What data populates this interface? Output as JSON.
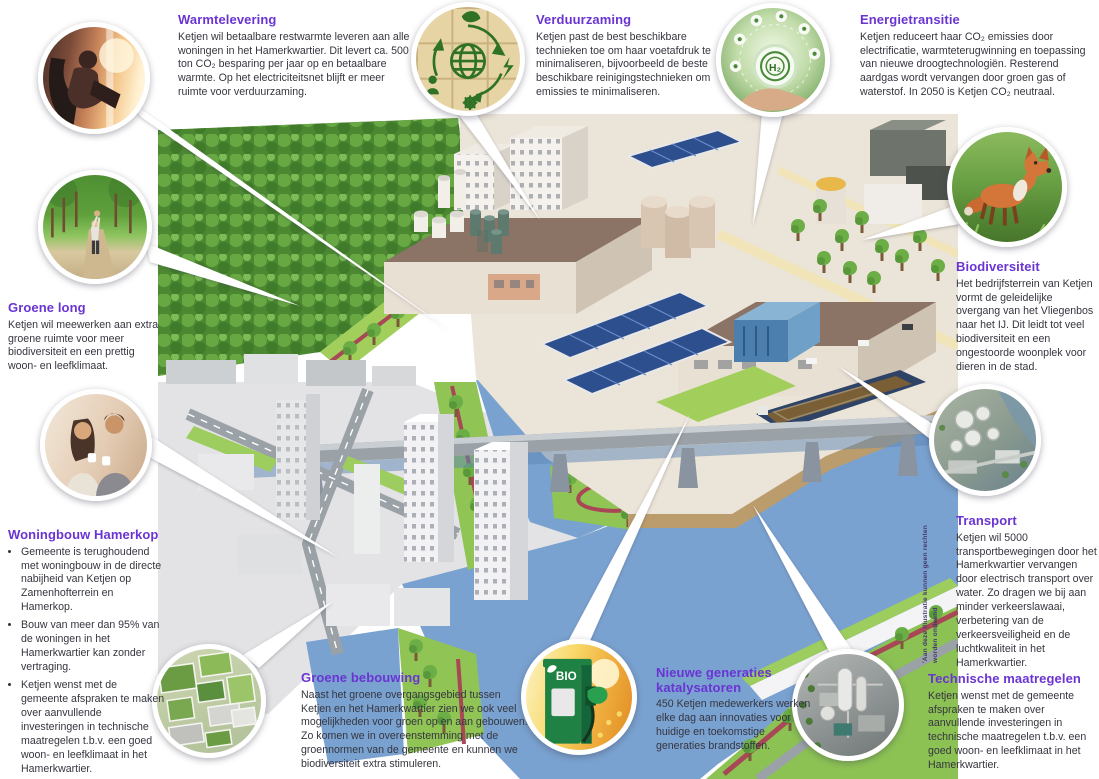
{
  "colors": {
    "accent_purple": "#6a34d2",
    "body_text": "#35353f",
    "river_blue": "#7aa2d0",
    "forest_green": "#4c8832",
    "grass_green": "#9ccd5e",
    "red_path": "#a84856",
    "roof_brown": "#8b7365",
    "solar_blue": "#2e4f8e"
  },
  "callouts": [
    {
      "id": "warmtelevering",
      "title": "Warmtelevering",
      "body": "Ketjen wil betaalbare restwarmte leveren aan alle woningen in het Hamerkwartier. Dit levert ca. 500 ton CO₂ besparing per jaar op en betaalbare warmte. Op het electriciteitsnet blijft er meer ruimte voor verduurzaming.",
      "photo": "woman-by-sunny-window"
    },
    {
      "id": "verduurzaming",
      "title": "Verduurzaming",
      "body": "Ketjen past de best beschikbare technieken toe om haar voetafdruk te minimaliseren, bijvoorbeeld de beste beschikbare reinigings­technieken om emissies te minimaliseren.",
      "photo": "sustainability-icons-on-wood-blocks"
    },
    {
      "id": "energietransitie",
      "title": "Energietransitie",
      "body": "Ketjen reduceert haar CO₂ emissies door electrificatie, warmteterugwinning en toepassing van nieuwe droogtechnologiën. Resterend aardgas wordt vervangen door groen gas of waterstof. In 2050 is Ketjen CO₂ neutraal.",
      "photo": "hand-holding-h2-sphere"
    },
    {
      "id": "biodiversiteit",
      "title": "Biodiversiteit",
      "body": "Het bedrijfsterrein van Ketjen vormt de geleidelijke overgang van het Vliegenbos naar het IJ. Dit leidt tot veel biodiversiteit en een ongestoorde woonplek voor dieren in de stad.",
      "photo": "fox-in-grass"
    },
    {
      "id": "transport",
      "title": "Transport",
      "body": "Ketjen wil 5000 transportbewegingen door het Hamerkwartier vervangen door electrisch transport over water. Zo dragen we bij aan minder verkeerslawaai, verbetering van de verkeersveiligheid en de luchtkwaliteit in het Hamerkwartier.",
      "photo": "aerial-industrial-waterfront"
    },
    {
      "id": "technische-maatregelen",
      "title": "Technische maatregelen",
      "body": "Ketjen wenst met de gemeente afspraken te maken over aanvullende investeringen in technische maatregelen t.b.v. een goed woon- en leefklimaat in het Hamerkwartier.",
      "photo": "aerial-chemical-plant"
    },
    {
      "id": "nieuwe-generaties-katalysatoren",
      "title": "Nieuwe generaties katalysatoren",
      "body": "450 Ketjen medewerkers werken elke dag aan innovaties voor huidige en toekomstige generaties brandstoffen.",
      "photo": "bio-fuel-pump"
    },
    {
      "id": "groene-bebouwing",
      "title": "Groene bebouwing",
      "body": "Naast het groene overgangsgebied tussen Ketjen en het Hamerkwartier zien we ook veel mogelijkheden voor groen op en aan gebouwen. Zo komen we in overeenstemming met de groennormen van de gemeente en kunnen we biodiversiteit extra stimuleren.",
      "photo": "green-roofs-aerial"
    },
    {
      "id": "groene-long",
      "title": "Groene long",
      "body": "Ketjen wil meewerken aan extra groene ruimte voor meer biodiversiteit en een prettig woon- en leefklimaat.",
      "photo": "family-on-park-path"
    },
    {
      "id": "woningbouw-hamerkop",
      "title": "Woningbouw Hamerkop",
      "bullets": [
        "Gemeente is terughoudend met woningbouw in de directe nabijheid van Ketjen op Zamenhofterrein en Hamerkop.",
        "Bouw van meer dan 95% van de woningen in het Hamerkwartier kan zonder vertraging.",
        "Ketjen wenst met de gemeente afspraken te maken over aanvullende investeringen in technische maatregelen t.b.v. een goed woon- en leefklimaat in het Hamerkwartier."
      ],
      "photo": "couple-drinking-coffee"
    }
  ],
  "illustration": {
    "bio_label": "BIO",
    "h2_label": "H₂",
    "disclaimer": "'Aan deze illustratie kunnen geen rechten worden ontleend"
  }
}
